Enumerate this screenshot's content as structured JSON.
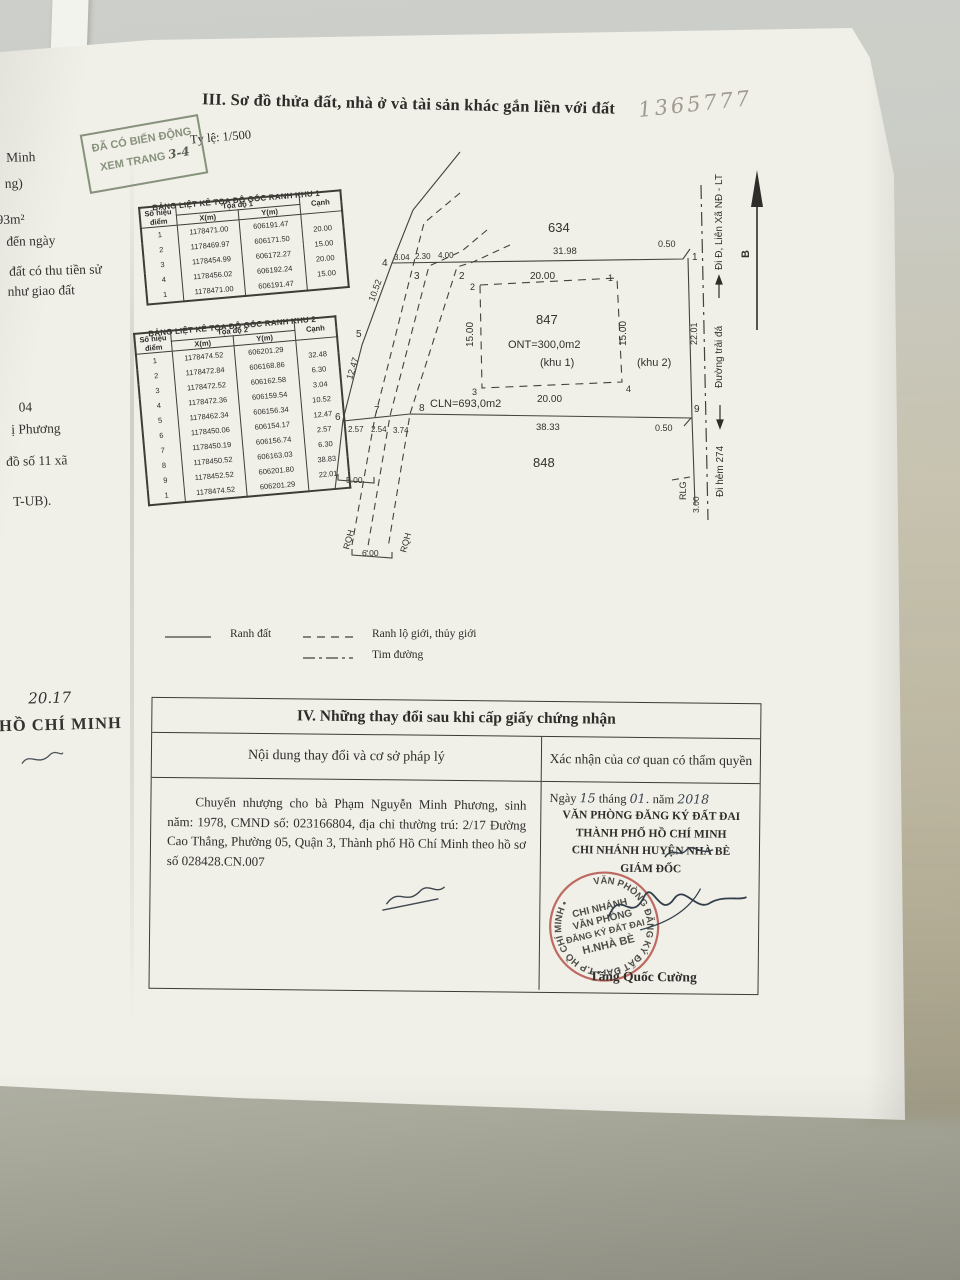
{
  "photo": {
    "handwritten_ref": "1365777"
  },
  "stamp_change": {
    "line1": "ĐÃ CÓ BIẾN ĐỘNG",
    "line2": "XEM TRANG",
    "handwritten_pages": "3-4"
  },
  "margin_fragments": [
    "Minh",
    "ng)",
    "693m²",
    "đến ngày",
    "đất có thu tiền sử",
    "như giao đất",
    "04",
    "ị Phương",
    "đồ số 11 xã",
    "T-UB)."
  ],
  "margin_handwritten_year": "20.17",
  "margin_city": "HỒ CHÍ MINH",
  "section3": {
    "title": "III. Sơ đồ thửa đất, nhà ở và tài sản khác gắn liền với đất",
    "scale": "Tỷ lệ: 1/500"
  },
  "table1": {
    "title": "BẢNG LIỆT KÊ TỌA ĐỘ GÓC RANH KHU 1",
    "header": {
      "point": "Số hiệu điểm",
      "group": "Tọa độ 1",
      "x": "X(m)",
      "y": "Y(m)",
      "edge": "Cạnh"
    },
    "rows": [
      {
        "p": "1",
        "x": "1178471.00",
        "y": "606191.47",
        "c": "20.00"
      },
      {
        "p": "2",
        "x": "1178469.97",
        "y": "606171.50",
        "c": "15.00"
      },
      {
        "p": "3",
        "x": "1178454.99",
        "y": "606172.27",
        "c": "20.00"
      },
      {
        "p": "4",
        "x": "1178456.02",
        "y": "606192.24",
        "c": "15.00"
      },
      {
        "p": "1",
        "x": "1178471.00",
        "y": "606191.47",
        "c": ""
      }
    ]
  },
  "table2": {
    "title": "BẢNG LIỆT KÊ TỌA ĐỘ GÓC RANH KHU 2",
    "header": {
      "point": "Số hiệu điểm",
      "group": "Tọa độ 2",
      "x": "X(m)",
      "y": "Y(m)",
      "edge": "Cạnh"
    },
    "rows": [
      {
        "p": "1",
        "x": "1178474.52",
        "y": "606201.29",
        "c": "32.48"
      },
      {
        "p": "2",
        "x": "1178472.84",
        "y": "606168.86",
        "c": "6.30"
      },
      {
        "p": "3",
        "x": "1178472.52",
        "y": "606162.58",
        "c": "3.04"
      },
      {
        "p": "4",
        "x": "1178472.36",
        "y": "606159.54",
        "c": "10.52"
      },
      {
        "p": "5",
        "x": "1178462.34",
        "y": "606156.34",
        "c": "12.47"
      },
      {
        "p": "6",
        "x": "1178450.06",
        "y": "606154.17",
        "c": "2.57"
      },
      {
        "p": "7",
        "x": "1178450.19",
        "y": "606156.74",
        "c": "6.30"
      },
      {
        "p": "8",
        "x": "1178450.52",
        "y": "606163.03",
        "c": "38.83"
      },
      {
        "p": "9",
        "x": "1178452.52",
        "y": "606201.80",
        "c": "22.01"
      },
      {
        "p": "1",
        "x": "1178474.52",
        "y": "606201.29",
        "c": ""
      }
    ]
  },
  "diagram": {
    "parcels": {
      "n634": "634",
      "n847": "847",
      "n848": "848"
    },
    "areas": {
      "ont": "ONT=300,0m2",
      "khu1": "(khu 1)",
      "khu2": "(khu 2)",
      "cln": "CLN=693,0m2"
    },
    "dims": {
      "d20": "20.00",
      "d15": "15.00",
      "d3198": "31.98",
      "d050": "0.50",
      "d3833": "38.33",
      "d304": "3.04",
      "d230": "2.30",
      "d400": "4.00",
      "d1052": "10.52",
      "d1247": "12.47",
      "d257": "2.57",
      "d254": "2.54",
      "d374": "3.74",
      "d500": "5.00",
      "d600": "6.00",
      "d2201": "22.01",
      "d300": "3.00"
    },
    "points": {
      "p1": "1",
      "p2": "2",
      "p3": "3",
      "p4": "4",
      "p5": "5",
      "p6": "6",
      "p7": "7",
      "p8": "8",
      "p9": "9"
    },
    "roads": {
      "lienxa": "Đi Đ, Liên Xã NĐ - LT",
      "traida": "Đường trải đá",
      "hem274": "Đi hẻm 274",
      "rlg": "RLG",
      "rqh": "RQH",
      "north": "B"
    }
  },
  "legend": {
    "ranh_dat": "Ranh đất",
    "ranh_lo_gioi": "Ranh lộ giới, thủy giới",
    "tim_duong": "Tim đường"
  },
  "section4": {
    "title": "IV. Những thay đổi sau khi cấp giấy chứng nhận",
    "col_content": "Nội dung thay đổi và cơ sở pháp lý",
    "col_confirm": "Xác nhận của cơ quan có thẩm quyền",
    "entry": "Chuyển nhượng cho bà Phạm Nguyễn Minh Phương, sinh năm: 1978, CMND số: 023166804, địa chỉ thường trú: 2/17 Đường Cao Thắng, Phường 05, Quận 3, Thành phố Hồ Chí Minh theo hồ sơ số 028428.CN.007",
    "date": {
      "ngay": "Ngày",
      "d": "15",
      "thang": "tháng",
      "m": "01.",
      "nam": "năm",
      "y": "2018"
    },
    "office1": "VĂN PHÒNG ĐĂNG KÝ ĐẤT ĐAI",
    "office2": "THÀNH PHỐ HỒ CHÍ MINH",
    "office3": "CHI NHÁNH HUYỆN NHÀ BÈ",
    "office4": "GIÁM ĐỐC",
    "signer": "Tăng Quốc Cường",
    "stamp": {
      "ring": "VĂN PHÒNG ĐĂNG KÝ ĐẤT ĐAI • T.P HỒ CHÍ MINH •",
      "c1": "CHI NHÁNH",
      "c2": "VĂN PHÒNG",
      "c3": "ĐĂNG KÝ ĐẤT ĐAI",
      "c4": "H.NHÀ BÈ"
    }
  },
  "colors": {
    "stamp_green": "#86927c",
    "stamp_red": "#b5534a",
    "ink": "#2e2d29"
  }
}
